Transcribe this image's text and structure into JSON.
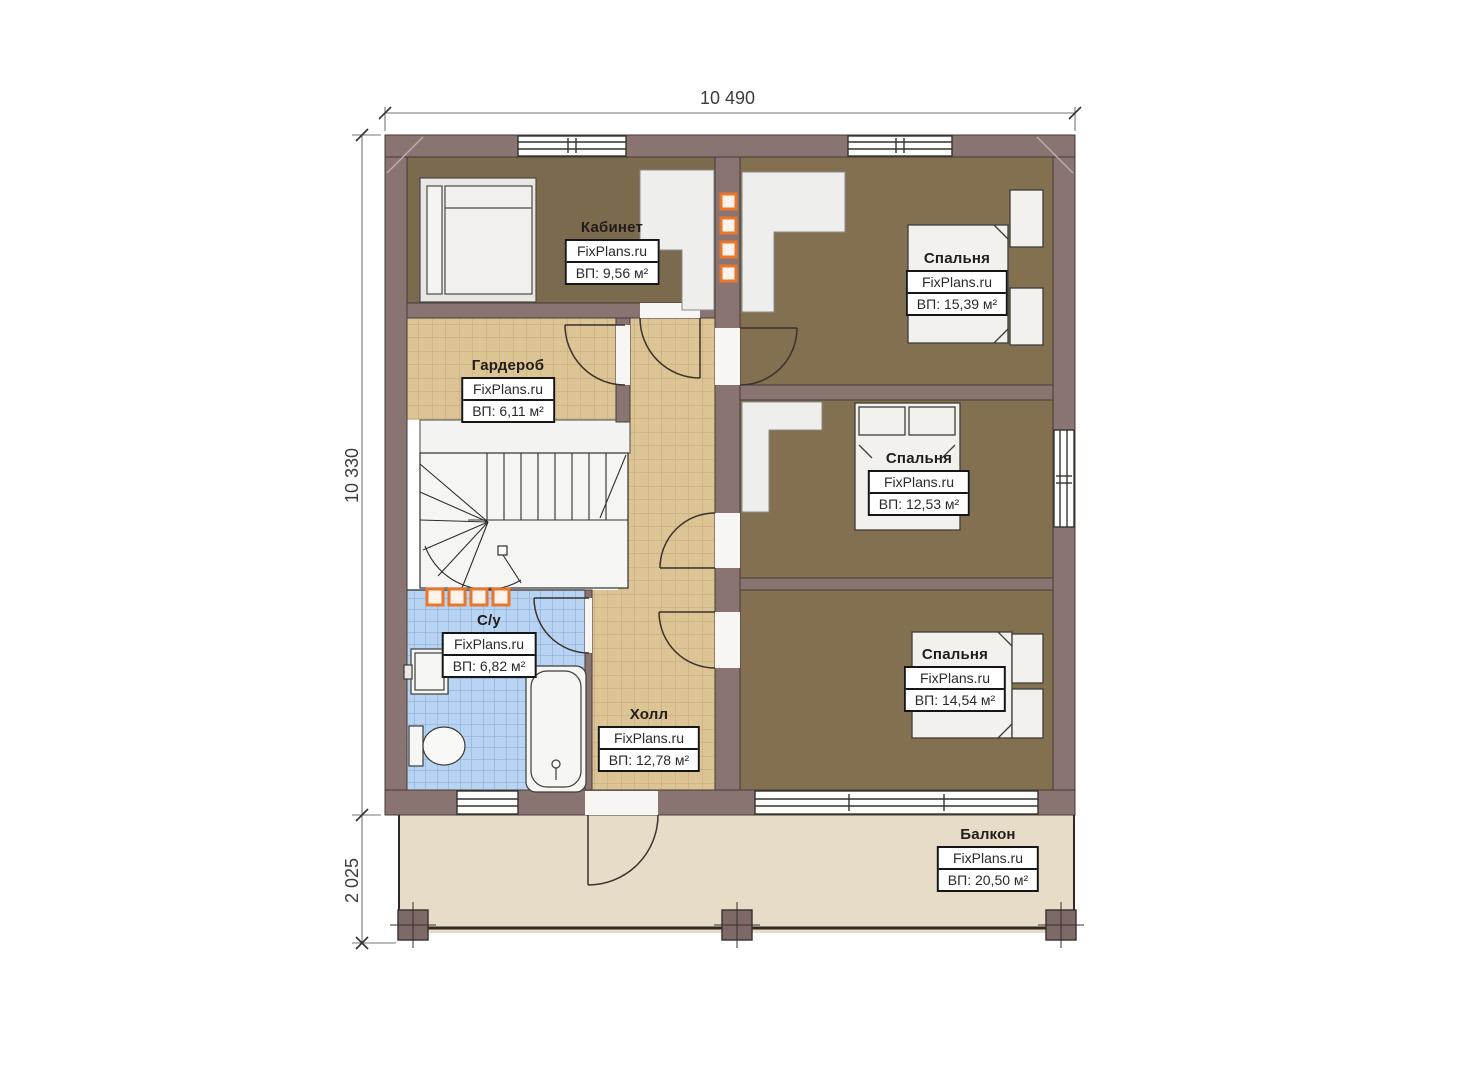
{
  "plan": {
    "brand": "FixPlans.ru",
    "dimensions": {
      "top_width": "10 490",
      "left_height": "10 330",
      "balcony_height": "2 025"
    },
    "rooms": {
      "office": {
        "name": "Кабинет",
        "brand": "FixPlans.ru",
        "area": "ВП: 9,56 м²"
      },
      "wardrobe": {
        "name": "Гардероб",
        "brand": "FixPlans.ru",
        "area": "ВП: 6,11 м²"
      },
      "bedroom_top": {
        "name": "Спальня",
        "brand": "FixPlans.ru",
        "area": "ВП: 15,39 м²"
      },
      "bedroom_middle": {
        "name": "Спальня",
        "brand": "FixPlans.ru",
        "area": "ВП: 12,53 м²"
      },
      "bedroom_bottom": {
        "name": "Спальня",
        "brand": "FixPlans.ru",
        "area": "ВП: 14,54 м²"
      },
      "bathroom": {
        "name": "С/у",
        "brand": "FixPlans.ru",
        "area": "ВП: 6,82 м²"
      },
      "hall": {
        "name": "Холл",
        "brand": "FixPlans.ru",
        "area": "ВП: 12,78 м²"
      },
      "balcony": {
        "name": "Балкон",
        "brand": "FixPlans.ru",
        "area": "ВП: 20,50 м²"
      }
    },
    "colors": {
      "wall": "#8a7471",
      "office_floor": "#7c6a4e",
      "bedroom_floor": "#827050",
      "hall_tile": "#dcc494",
      "bathroom_tile": "#b9d4f2",
      "balcony_floor": "#e7dcc7",
      "accent_orange": "#e8762c"
    }
  }
}
